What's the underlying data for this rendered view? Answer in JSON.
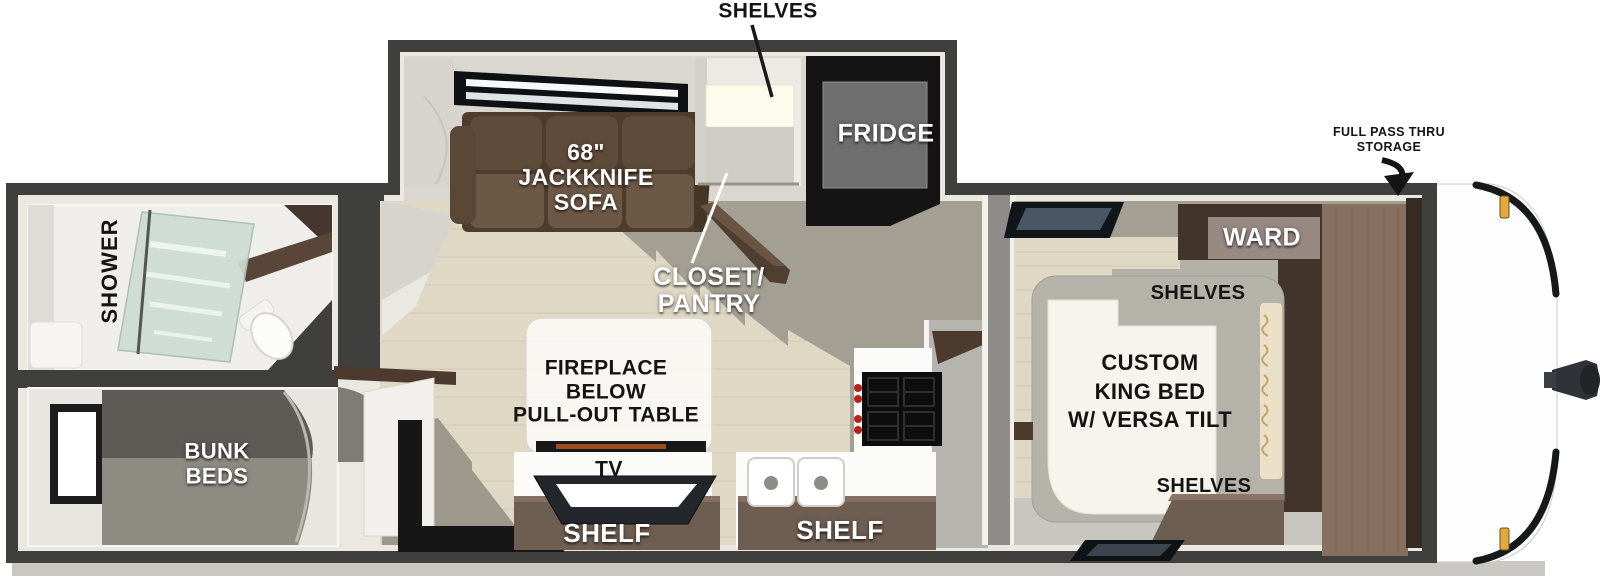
{
  "callouts": {
    "shelves_top": "SHELVES",
    "full_pass_thru_storage": "FULL PASS THRU\nSTORAGE"
  },
  "living_kitchen": {
    "sofa": "68\"\nJACKKNIFE\nSOFA",
    "fridge": "FRIDGE",
    "closet_pantry": "CLOSET/\nPANTRY",
    "fireplace_table": "FIREPLACE\nBELOW\nPULL-OUT TABLE",
    "tv": "TV",
    "shelf_left": "SHELF",
    "shelf_right": "SHELF"
  },
  "front_bedroom": {
    "ward": "WARD",
    "shelves_head": "SHELVES",
    "king_bed": "CUSTOM\nKING BED\nW/ VERSA TILT",
    "shelves_foot": "SHELVES"
  },
  "rear_rooms": {
    "shower": "SHOWER",
    "bunk_beds": "BUNK\nBEDS"
  },
  "colors": {
    "wall": "#3f3f3d",
    "lining": "#eae8e1",
    "floor_wood": "#ded8c5",
    "floor_gray": "#a49f93",
    "sofa_brown": "#5f4b3a",
    "cabinet_dark": "#44362d",
    "wood_panel": "#877060",
    "counter_white": "#fcfcfa",
    "stove_black": "#0d0d0d",
    "knob_red": "#b7221c",
    "marker_amber": "#e2a93f"
  }
}
